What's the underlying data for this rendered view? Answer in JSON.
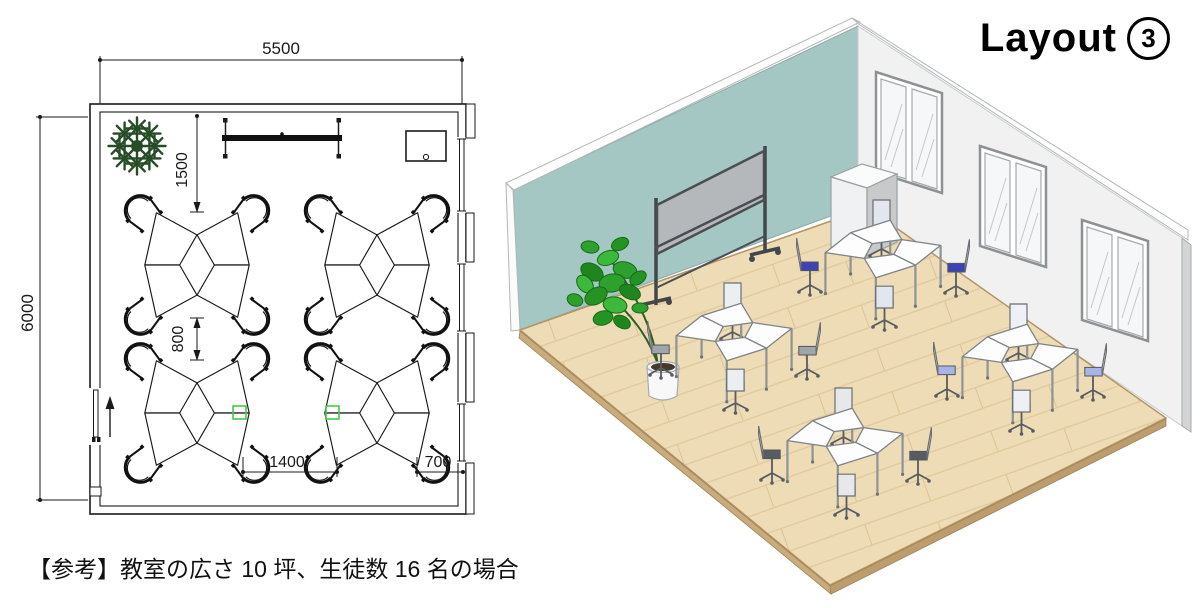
{
  "title": {
    "label": "Layout",
    "number": "3",
    "full": "Layout ③"
  },
  "caption": "【参考】教室の広さ 10 坪、生徒数 16 名の場合",
  "floor_plan": {
    "dim_room_width": "5500",
    "dim_room_depth": "6000",
    "dim_front_clearance": "1500",
    "dim_row_gap": "800",
    "dim_group_gap": "1400",
    "dim_side_gap": "700"
  },
  "colors": {
    "accent_wall": "#a5c7c3",
    "side_wall": "#f1f1f2",
    "floor_wood": "#eedcb6",
    "whiteboard_panel": "#b5b8ba",
    "chair_blue": "#3d42b4",
    "chair_light_blue": "#a7b4e6",
    "chair_gray": "#9fa6ab",
    "chair_dark_gray": "#565c62",
    "plant_green": "#2da02d",
    "plan_marker_green": "#44cc44"
  }
}
